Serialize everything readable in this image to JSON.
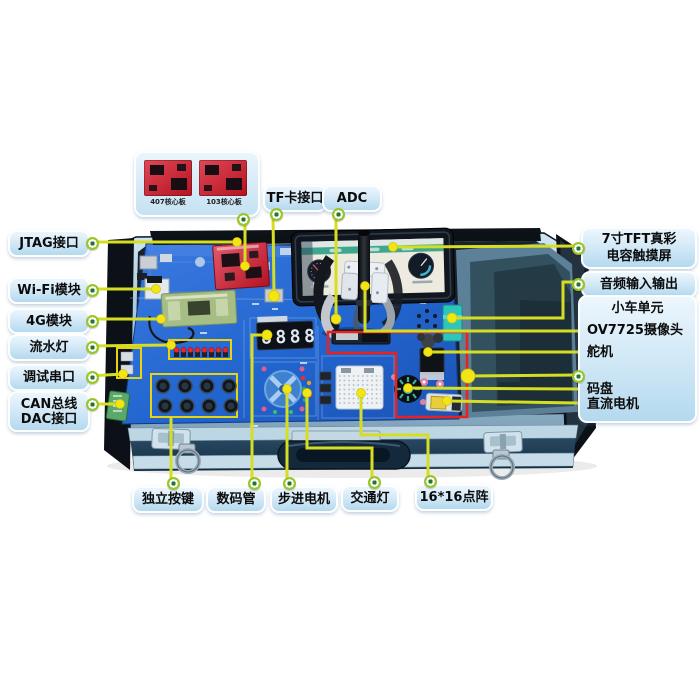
{
  "colors": {
    "leader_line": "#d6de23",
    "component_dot": "#f2e513",
    "callout_dot_green": "#8cc63e",
    "highlight_red": "#e8231f",
    "board_blue": "#2265cf",
    "label_bg": "#cde7f8",
    "case_aluminum": "#b9d5e6",
    "foam_dark": "#32505e"
  },
  "core_board_panel": {
    "boards": [
      {
        "caption": "407核心板"
      },
      {
        "caption": "103核心板"
      }
    ]
  },
  "board": {
    "segment_value": "8888"
  },
  "callouts": {
    "jtag": {
      "label": "JTAG接口"
    },
    "wifi": {
      "label": "Wi-Fi模块"
    },
    "module_4g": {
      "label": "4G模块"
    },
    "running_led": {
      "label": "流水灯"
    },
    "debug_uart": {
      "label": "调试串口"
    },
    "can": {
      "line1": "CAN总线",
      "line2": "DAC接口"
    },
    "tf_card": {
      "label": "TF卡接口"
    },
    "adc": {
      "label": "ADC"
    },
    "tft": {
      "line1": "7寸TFT真彩",
      "line2": "电容触摸屏"
    },
    "audio": {
      "label": "音频输入输出"
    },
    "car_unit": {
      "title": "小车单元",
      "camera": "OV7725摄像头",
      "servo": "舵机",
      "encoder": "码盘",
      "dc_motor": "直流电机"
    },
    "keys": {
      "label": "独立按键"
    },
    "segment_display": {
      "label": "数码管"
    },
    "stepper": {
      "label": "步进电机"
    },
    "traffic": {
      "label": "交通灯"
    },
    "dot_matrix": {
      "label": "16*16点阵"
    }
  }
}
